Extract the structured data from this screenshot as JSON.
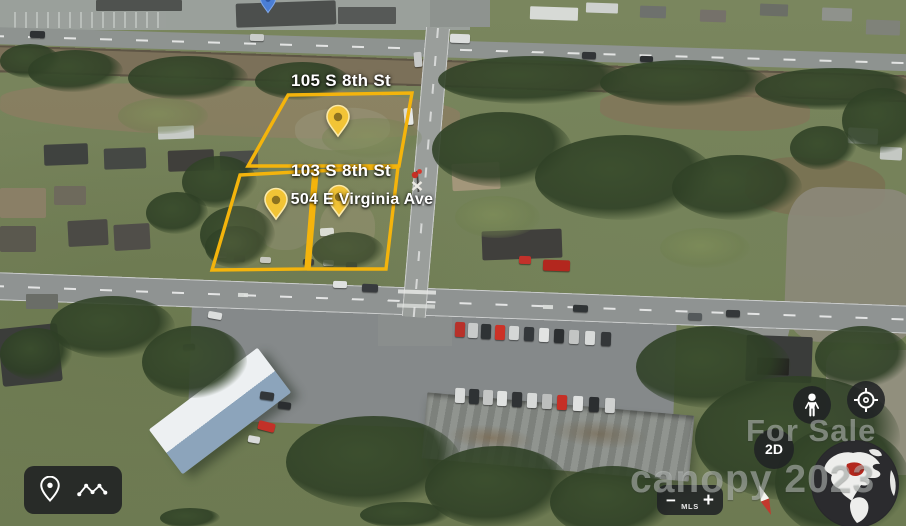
{
  "labels": {
    "p105": "105 S 8th St",
    "p103": "103 S 8th St",
    "p504": "504 E Virginia Ave"
  },
  "watermark": {
    "line1": "For Sale",
    "line2": "canopy 2023"
  },
  "controls": {
    "view_toggle": "2D",
    "zoom_out": "−",
    "zoom_in": "+",
    "zoom_brand": "MLS"
  },
  "colors": {
    "parcel_outline": "#f4b40c",
    "pin_body": "#f2c436",
    "pin_rim": "#fae9a8",
    "pin_dot": "#8d721f",
    "control_bg": "rgba(32,34,36,0.88)",
    "label_text": "#ffffff",
    "watermark_text": "rgba(210,214,212,0.48)"
  }
}
